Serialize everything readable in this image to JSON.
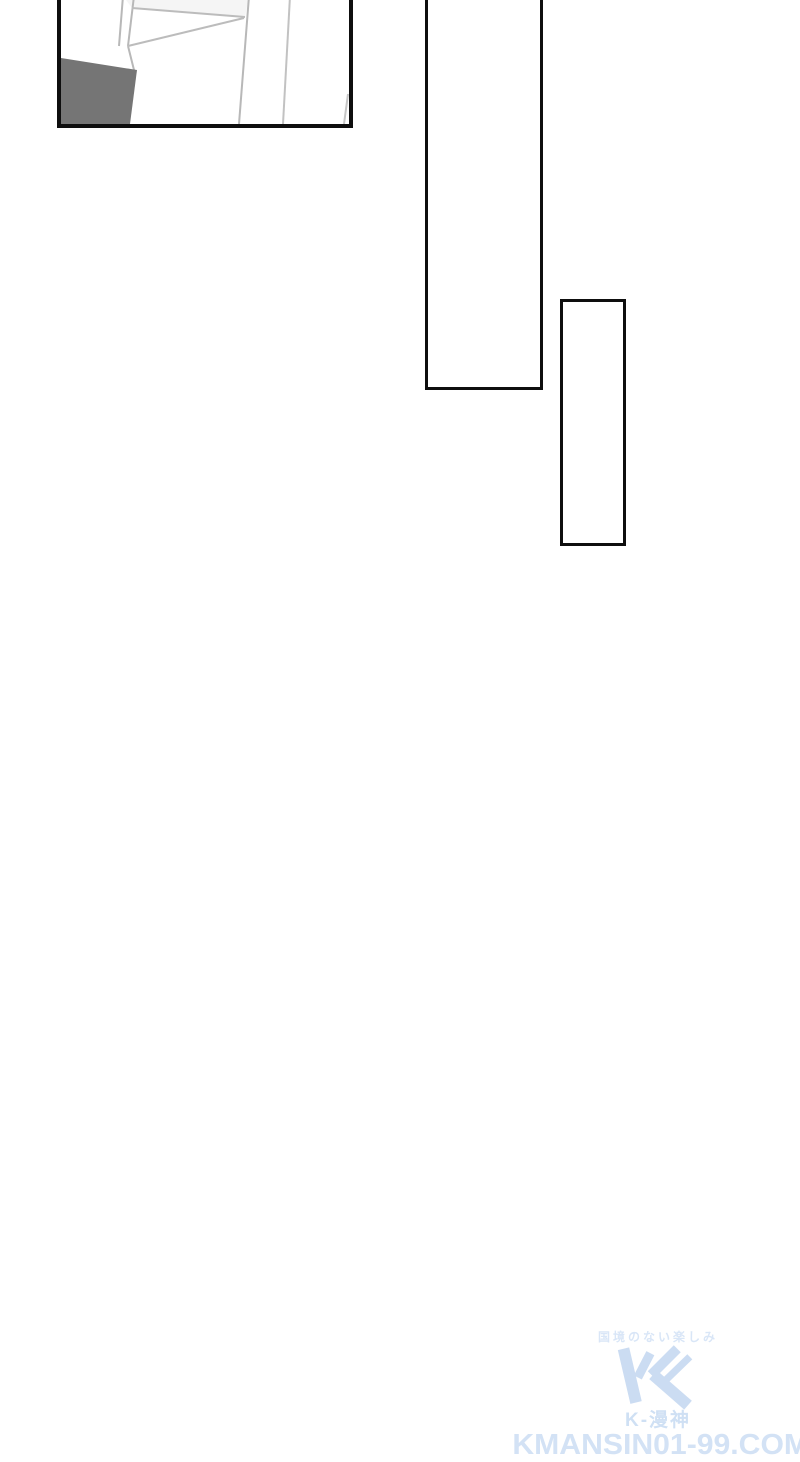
{
  "page": {
    "background_color": "#ffffff",
    "panel_border_color": "#0e0e0e"
  },
  "panel_art": {
    "description": "interior line-art, tilted wall and window frame with gray desk corner",
    "shape_color": "#757575",
    "line_color": "#b8b8b8",
    "shade_color": "#f1f1f1"
  },
  "watermark": {
    "tagline": "国境のない楽しみ",
    "brand": "K-漫神",
    "url": "KMANSIN01-99.COM",
    "tagline_color": "#d9e6f7",
    "logo_color": "#cbdcf2",
    "brand_color": "#cfe0f4",
    "url_color": "#d3e2f5"
  }
}
